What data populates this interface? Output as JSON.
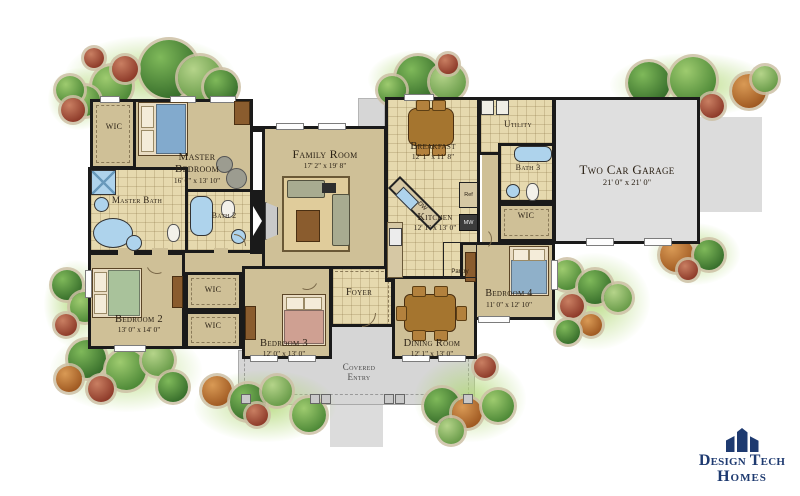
{
  "plan": {
    "rooms": [
      {
        "name": "WIC",
        "dims": ""
      },
      {
        "name": "Master Bedroom",
        "dims": "16' 0\" x 13' 10\""
      },
      {
        "name": "Master Bath",
        "dims": ""
      },
      {
        "name": "Bath 2",
        "dims": ""
      },
      {
        "name": "Family Room",
        "dims": "17' 2\" x 19' 8\""
      },
      {
        "name": "Breakfast",
        "dims": "12' 1\" x 11' 8\""
      },
      {
        "name": "Kitchen",
        "dims": "12' 1\" x 13' 0\""
      },
      {
        "name": "Utility",
        "dims": ""
      },
      {
        "name": "Bath 3",
        "dims": ""
      },
      {
        "name": "WIC",
        "dims": ""
      },
      {
        "name": "Two Car Garage",
        "dims": "21' 0\" x 21' 0\""
      },
      {
        "name": "Bedroom 4",
        "dims": "11' 0\" x 12' 10\""
      },
      {
        "name": "Bedroom 2",
        "dims": "13' 0\" x 14' 0\""
      },
      {
        "name": "WIC",
        "dims": ""
      },
      {
        "name": "WIC",
        "dims": ""
      },
      {
        "name": "Bedroom 3",
        "dims": "12' 0\" x 13' 0\""
      },
      {
        "name": "Foyer",
        "dims": ""
      },
      {
        "name": "Dining Room",
        "dims": "12' 1\" x 13' 0\""
      },
      {
        "name": "Covered Entry",
        "dims": ""
      }
    ],
    "appliances": {
      "dw": "DW",
      "ref": "Ref",
      "mw": "MW",
      "pantry": "Pantry"
    }
  },
  "logo": {
    "line1": "Design Tech",
    "line2": "Homes"
  },
  "colors": {
    "wall": "#1a1a1a",
    "carpet": "#cfc097",
    "tile": "#e6d9ae",
    "garage_floor": "#dfdfdf",
    "porch": "#d6d6d6",
    "water_fixture": "#aed3ec",
    "logo_navy": "#1e3a70"
  }
}
